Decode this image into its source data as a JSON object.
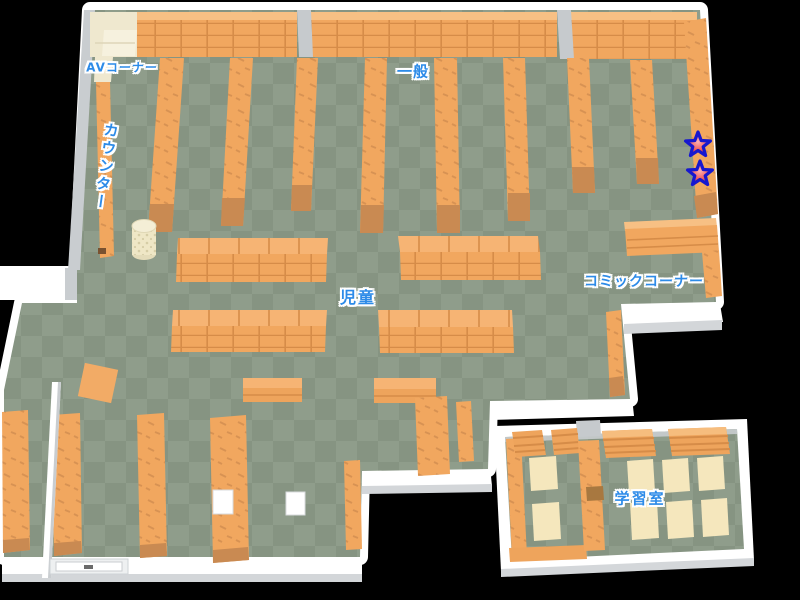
{
  "map": {
    "labels": [
      {
        "id": "av-corner",
        "text": "AVコーナー"
      },
      {
        "id": "counter",
        "text": "カウンター"
      },
      {
        "id": "general",
        "text": "一般"
      },
      {
        "id": "children",
        "text": "児童"
      },
      {
        "id": "comic-corner",
        "text": "コミックコーナー"
      },
      {
        "id": "study-room",
        "text": "学習室"
      }
    ],
    "markers": [
      {
        "id": "star-1",
        "icon": "star"
      },
      {
        "id": "star-2",
        "icon": "star"
      }
    ],
    "colors": {
      "background": "#000000",
      "wall_white": "#ffffff",
      "wall_shade": "#c9cdd0",
      "floor_light": "#8f9d8b",
      "floor_dark": "#869482",
      "shelf_orange": "#f1a75f",
      "shelf_line": "#d68c48",
      "shelf_end": "#c98a52",
      "av_cream": "#efe8cf",
      "table_cream": "#f5e7bd",
      "label_blue": "#2d8be8",
      "star_red": "#ee4848",
      "star_outline": "#1717cf"
    }
  }
}
